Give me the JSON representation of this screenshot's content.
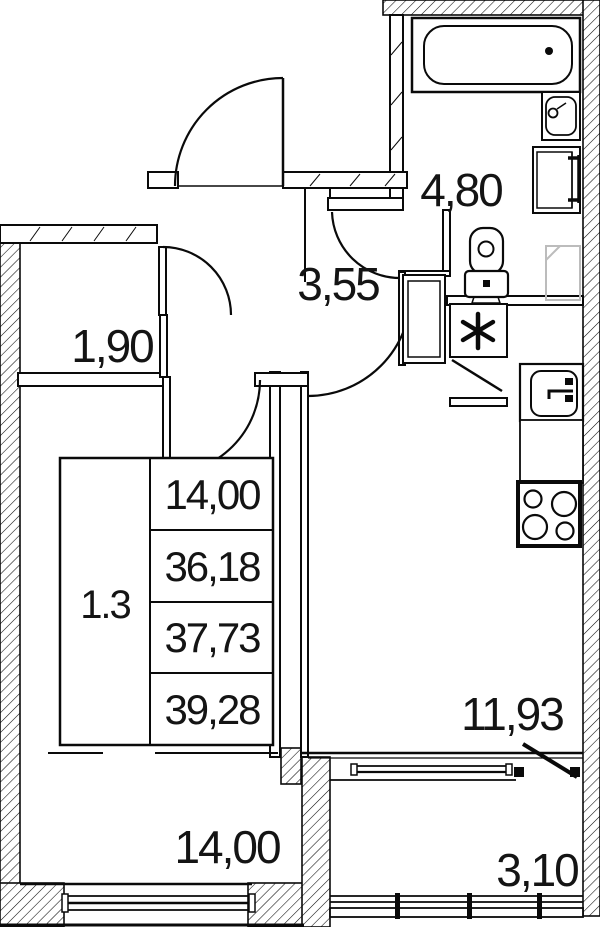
{
  "plan": {
    "type": "apartment-floor-plan",
    "rooms": {
      "closet": {
        "area": "1,90"
      },
      "hallway": {
        "area": "3,55"
      },
      "bathroom": {
        "area": "4,80"
      },
      "living": {
        "area": "14,00"
      },
      "kitchen": {
        "area": "11,93"
      },
      "balcony": {
        "area": "3,10"
      }
    },
    "stamp": {
      "apartment": "1.3",
      "living_area": "14,00",
      "area": "36,18",
      "total_area": "37,73",
      "total_with_balcony": "39,28"
    },
    "marks": {
      "washing_machine": "asterisk"
    },
    "colors": {
      "line": "#0a0a0a",
      "faint_fixture": "#bcbcbc",
      "background": "#ffffff"
    }
  }
}
